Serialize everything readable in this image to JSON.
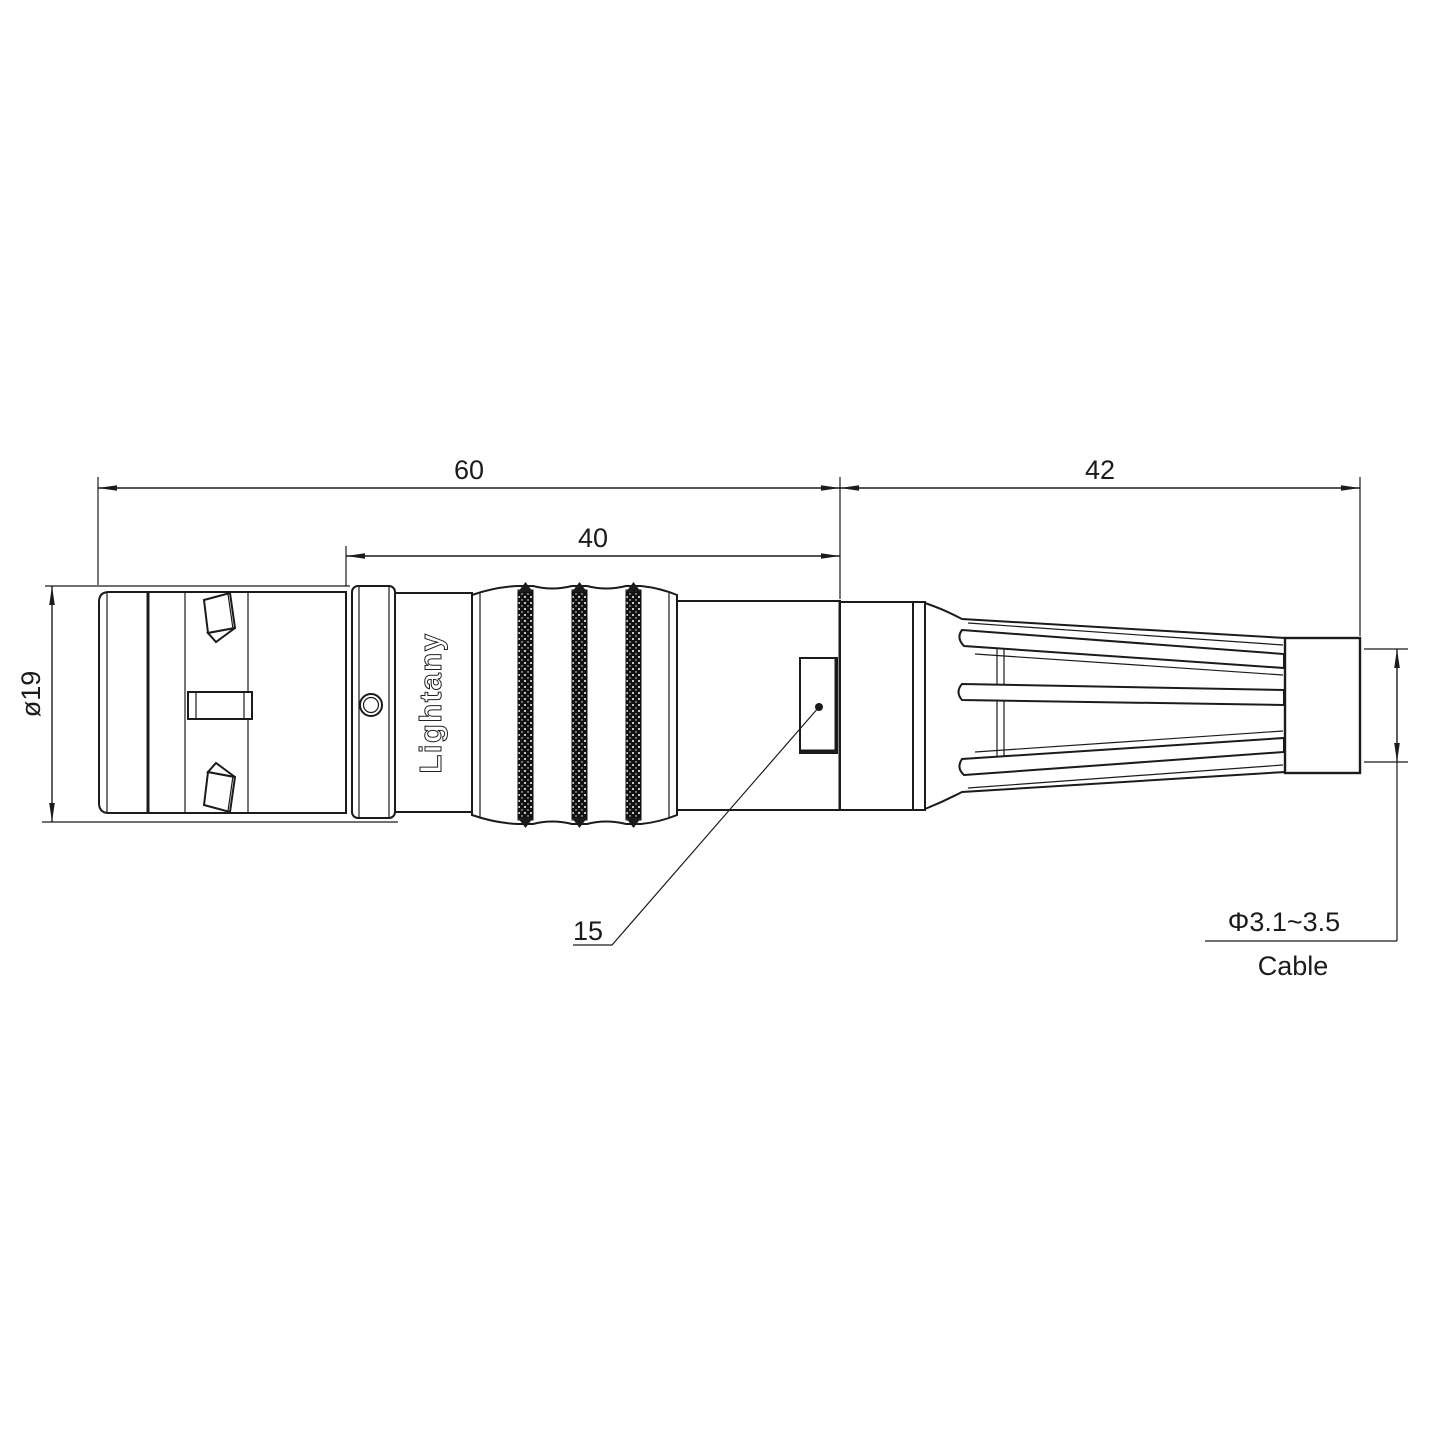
{
  "page": {
    "background": "#ffffff",
    "description": "Technical dimension drawing of a push-pull circular connector straight plug with strain relief, side view"
  },
  "watermark": {
    "text": "Lightany",
    "color": "#f3bcbc"
  },
  "part": {
    "brand_label": "Lightany"
  },
  "colors": {
    "line": "#1b1b1b",
    "background": "#ffffff"
  },
  "dimensions": {
    "front_length": "60",
    "mid_length": "40",
    "rear_length": "42",
    "front_diameter": "ø19",
    "detail_number": "15",
    "cable_diameter": "Φ3.1~3.5",
    "cable_word": "Cable"
  }
}
